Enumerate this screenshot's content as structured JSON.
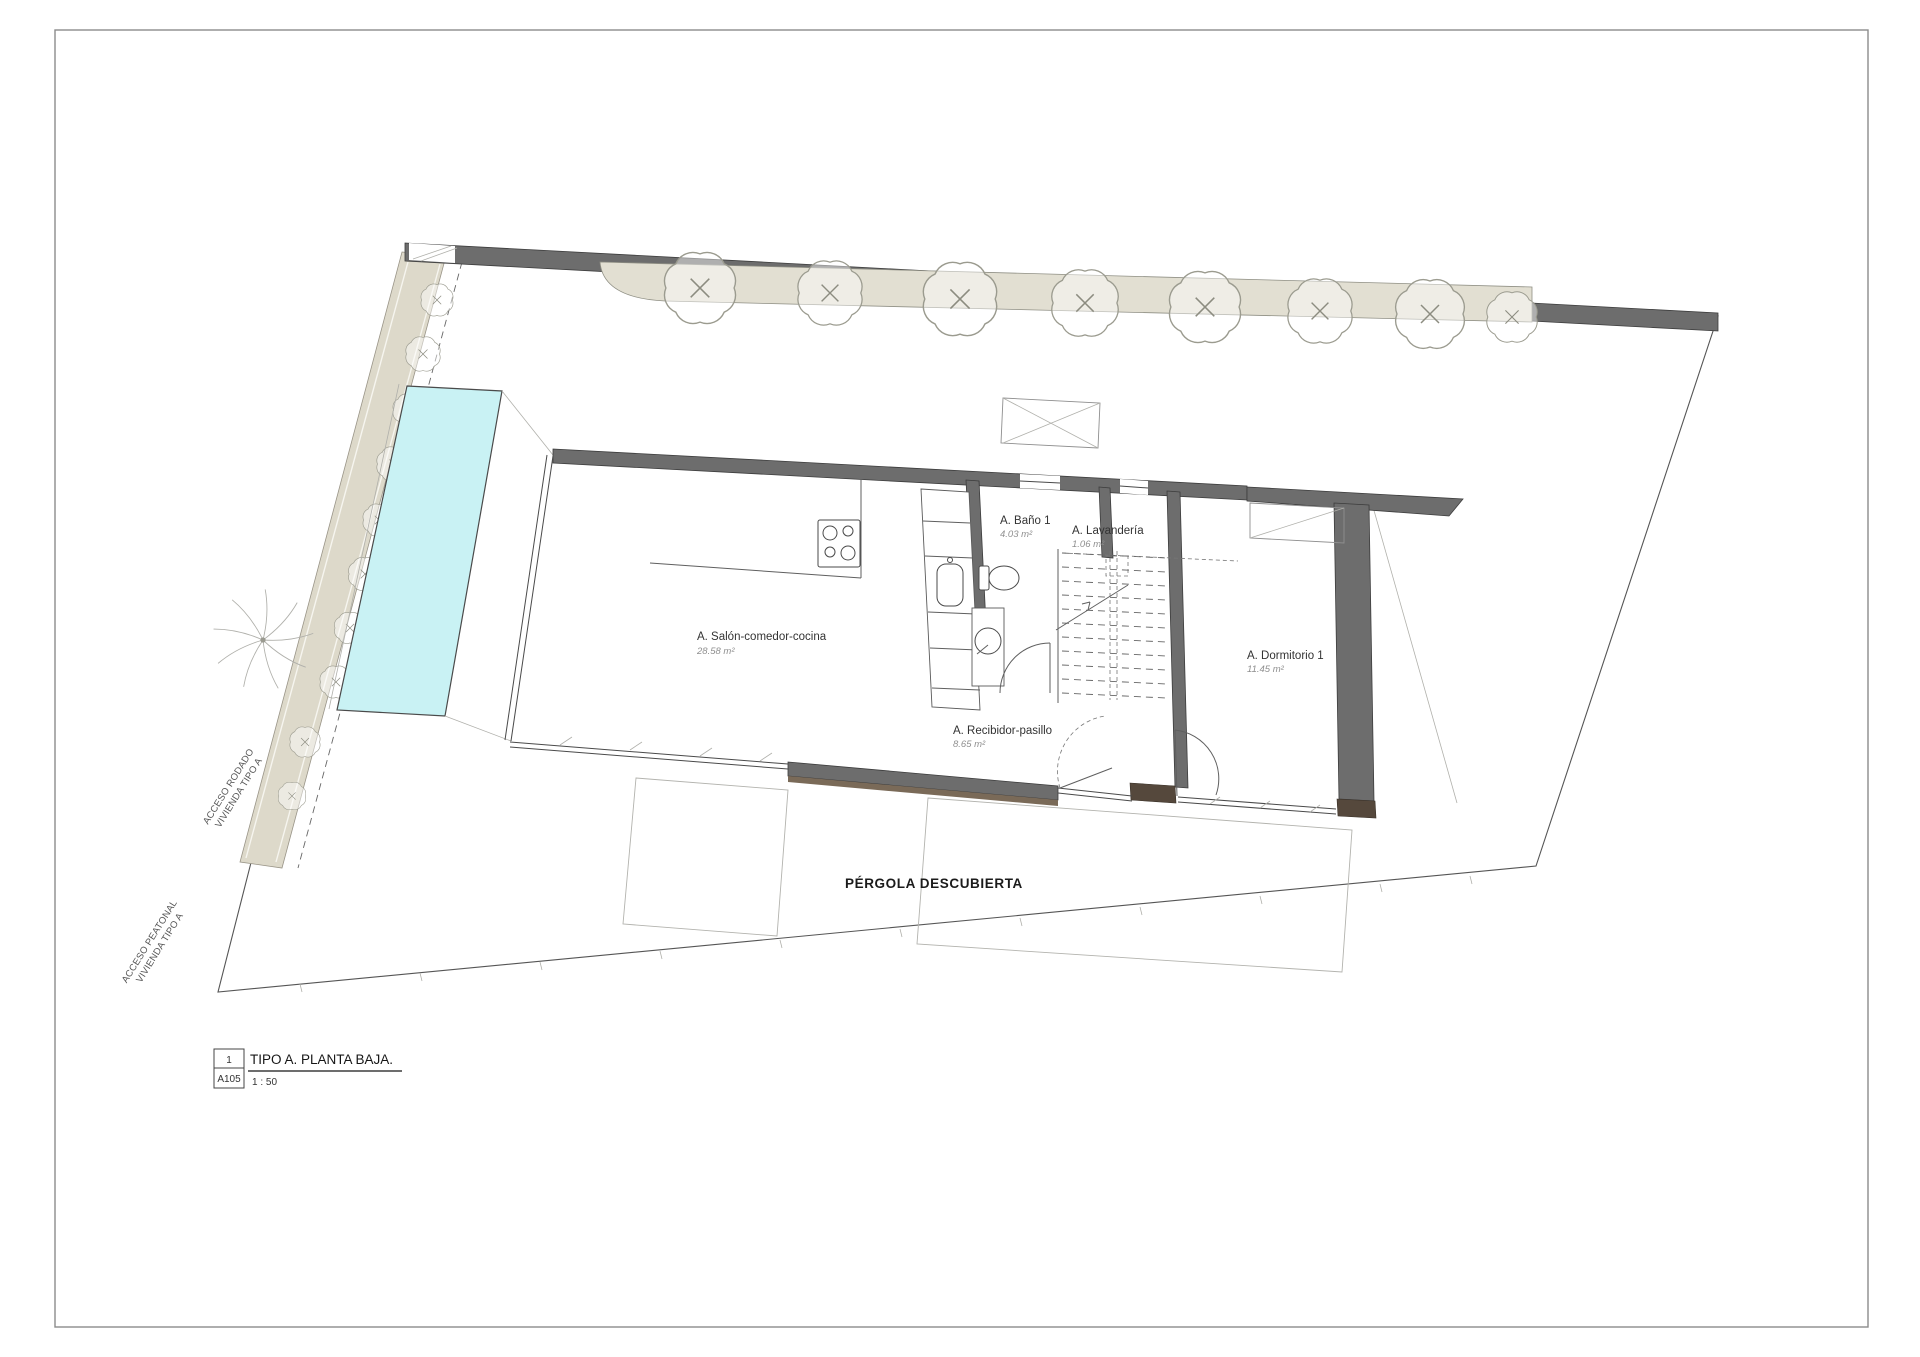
{
  "sheet": {
    "view_number": "1",
    "sheet_code": "A105",
    "view_title": "TIPO A. PLANTA BAJA.",
    "view_scale": "1 : 50"
  },
  "rooms": [
    {
      "label": "A. Salón-comedor-cocina",
      "area": "28.58 m²"
    },
    {
      "label": "A. Baño 1",
      "area": "4.03 m²"
    },
    {
      "label": "A. Lavandería",
      "area": "1.06 m²"
    },
    {
      "label": "A. Dormitorio 1",
      "area": "11.45 m²"
    },
    {
      "label": "A. Recibidor-pasillo",
      "area": "8.65 m²"
    }
  ],
  "site": {
    "pergola_label": "PÉRGOLA DESCUBIERTA",
    "access_road": {
      "line1": "ACCESO RODADO",
      "line2": "VIVIENDA TIPO A"
    },
    "access_pedestrian": {
      "line1": "ACCESO PEATONAL",
      "line2": "VIVIENDA TIPO A"
    }
  },
  "colors": {
    "wall": "#6d6d6d",
    "pool_water": "#c9f2f4",
    "landscape_fill": "#e2dfd2",
    "timber": "#55483c"
  }
}
